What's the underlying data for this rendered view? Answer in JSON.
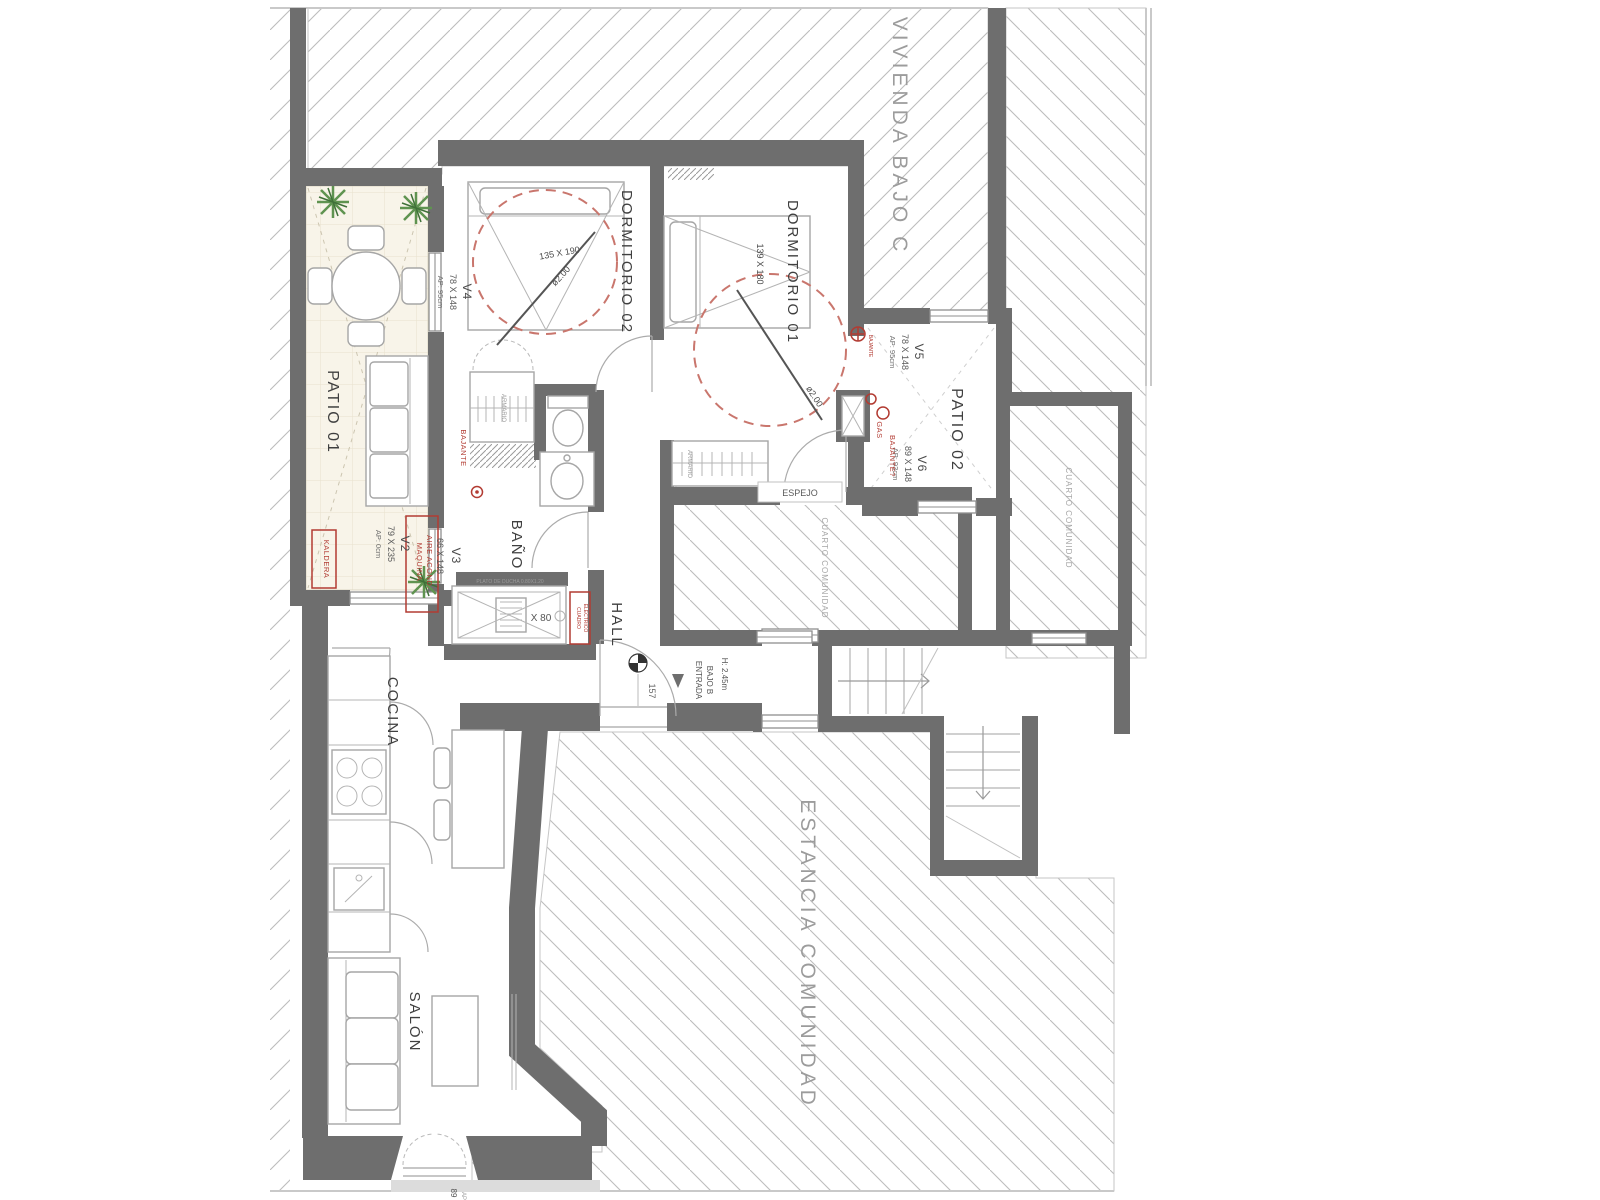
{
  "neighbors": {
    "vivienda": "VIVIENDA BAJO C",
    "estancia": "ESTANCIA COMUNIDAD",
    "cuarto1": "CUARTO COMUNIDAD",
    "cuarto2": "CUARTO COMUNIDAD"
  },
  "rooms": {
    "patio1": "PATIO 01",
    "patio2": "PATIO 02",
    "dorm1": "DORMITORIO 01",
    "dorm2": "DORMITORIO 02",
    "bath": "BAÑO",
    "hall": "HALL",
    "kitchen": "COCINA",
    "living": "SALÓN"
  },
  "windows": {
    "v2": {
      "id": "V2",
      "size": "79 X 235",
      "sill": "AP: 0cm"
    },
    "v3": {
      "id": "V3",
      "size": "66 X 148"
    },
    "v4": {
      "id": "V4",
      "size": "78 X 148",
      "sill": "AP: 95cm"
    },
    "v5": {
      "id": "V5",
      "size": "78 X 148",
      "sill": "AP: 95cm"
    },
    "v6": {
      "id": "V6",
      "size": "89 X 148",
      "sill": "AP: 93cm"
    }
  },
  "beds": {
    "bed1_size": "139 X 180",
    "bed1_turn": "ø2.00",
    "bed2_size": "135 X 190",
    "bed2_turn": "ø2.00"
  },
  "entrance": {
    "height": "H: 2.45m",
    "label1": "ENTRADA",
    "label2": "BAJO B",
    "door_width": "157"
  },
  "fixtures": {
    "mirror": "ESPEJO",
    "wardrobe1": "ARMARIO",
    "wardrobe2": "ARMARIO",
    "shower_tray": "PLATO DE DUCHA 0.80X1.20",
    "shower_size": "X 80"
  },
  "annotations": {
    "boiler": "KALDERA",
    "ac_line1": "MAQUINA",
    "ac_line2": "AIRE ACOND.",
    "gas": "GAS",
    "downpipe_left": "BAJANTE",
    "downpipe_small": "BAJANTE",
    "downpipe_q": "BAJANTE?",
    "panel_line1": "CUADRO",
    "panel_line2": "ELECTRICO",
    "edge_cut1": "89",
    "edge_cut2": "AP"
  },
  "colors": {
    "wall": "#6e6e6e",
    "annotation_red": "#b23b32",
    "hatch": "#bdbdbd",
    "patio_fill": "#f8f4e9",
    "plant_green": "#5f9350",
    "label_gray": "#9c9c9c"
  }
}
